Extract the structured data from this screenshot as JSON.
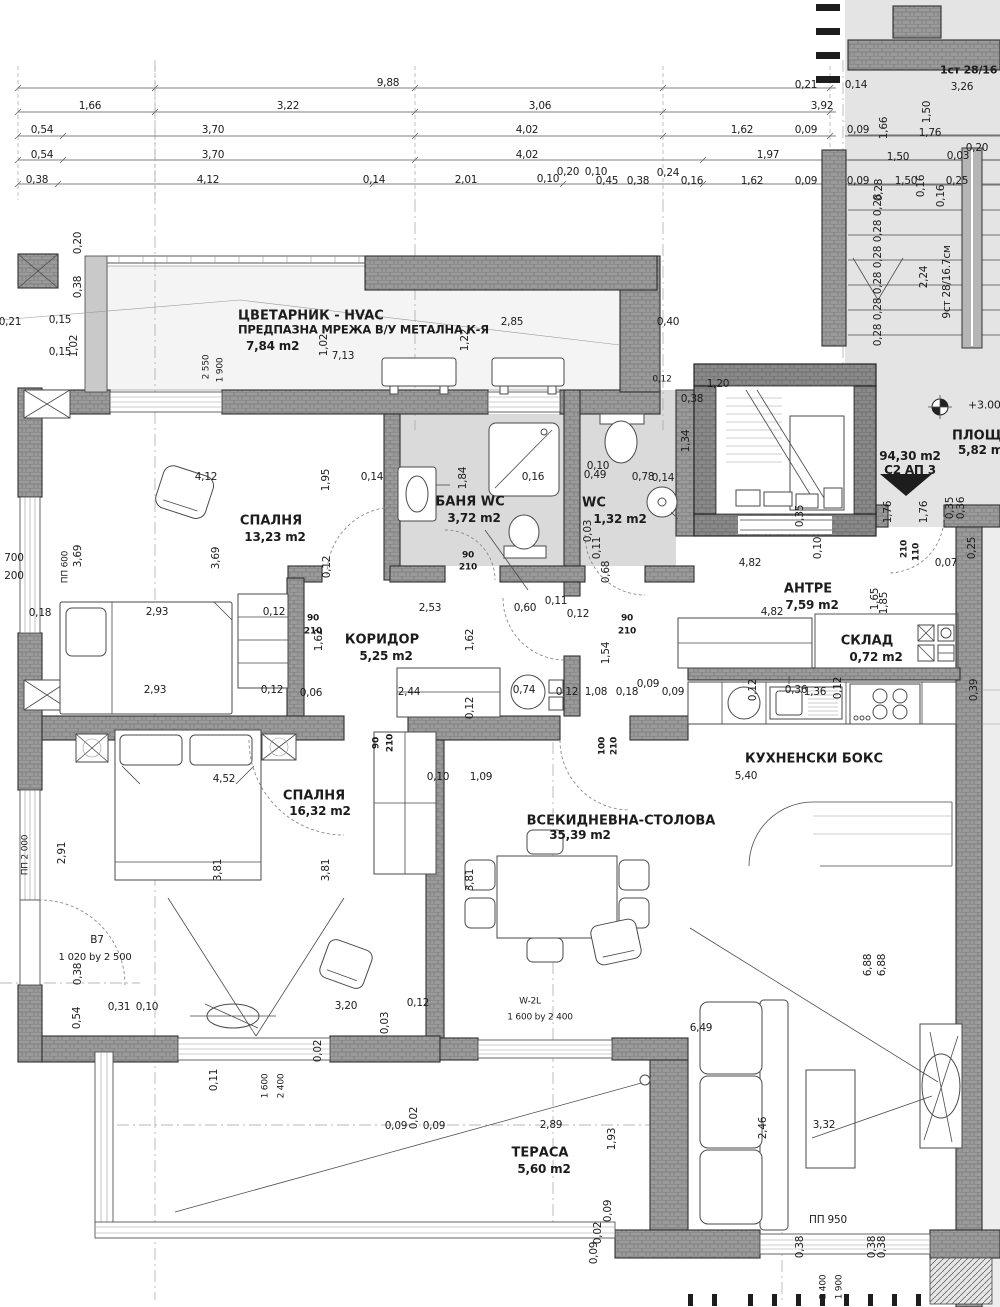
{
  "colors": {
    "paper": "#ffffff",
    "ink": "#1c1c1c",
    "wall_fill": "#9b9b9b",
    "wall_line": "#2f2f2f",
    "floor_tile": "#dadada",
    "stair_bg": "#e4e4e4"
  },
  "apartment": {
    "area_label": "94,30 m2",
    "unit_label": "С2 АП 3",
    "level_mark": "+3.00"
  },
  "stairs": {
    "flight_down": "1ст 28/16",
    "flight_up": "9ст 28/16.7см",
    "landing": "ПЛОЩАДКА 5,82 m2"
  },
  "rooms": [
    {
      "n": "СПАЛНЯ",
      "a": "13,23 m2",
      "x": 271,
      "y": 521
    },
    {
      "n": "БАНЯ WC",
      "a": "3,72 m2",
      "x": 470,
      "y": 502
    },
    {
      "n": "WC",
      "a": "1,32 m2",
      "x": 594,
      "y": 503,
      "ax": 620,
      "ay": 519
    },
    {
      "n": "КОРИДОР",
      "a": "5,25 m2",
      "x": 382,
      "y": 640
    },
    {
      "n": "АНТРЕ",
      "a": "7,59 m2",
      "x": 808,
      "y": 589
    },
    {
      "n": "СКЛАД",
      "a": "0,72 m2",
      "x": 867,
      "y": 641,
      "ax": 876,
      "ay": 657
    },
    {
      "n": "КУХНЕНСКИ БОКС",
      "a": "",
      "x": 814,
      "y": 759
    },
    {
      "n": "ВСЕКИДНЕВНА-СТОЛОВА",
      "a": "35,39 m2",
      "x": 621,
      "y": 821,
      "ax": 580,
      "ay": 835
    },
    {
      "n": "СПАЛНЯ",
      "a": "16,32 m2",
      "x": 314,
      "y": 796,
      "ax": 320,
      "ay": 811
    },
    {
      "n": "ТЕРАСА",
      "a": "5,60 m2",
      "x": 540,
      "y": 1153
    },
    {
      "n": "ЦВЕТАРНИК - HVAC",
      "note": "ПРЕДПАЗНА МРЕЖА В/У МЕТАЛНА К-Я",
      "a": "7,84 m2",
      "x": 238,
      "y": 316,
      "align": "l"
    },
    {
      "n": "ПЛОЩАДКА",
      "a": "5,82 m2",
      "x": 952,
      "y": 436,
      "ax": 958,
      "ay": 450,
      "align": "l"
    }
  ],
  "labels": [
    [
      "9,88",
      388,
      83
    ],
    [
      "0,21",
      806,
      85
    ],
    [
      "0,14",
      856,
      85
    ],
    [
      "1,66",
      90,
      106
    ],
    [
      "3,22",
      288,
      106
    ],
    [
      "3,06",
      540,
      106
    ],
    [
      "3,92",
      822,
      106
    ],
    [
      "0,54",
      42,
      130
    ],
    [
      "3,70",
      213,
      130
    ],
    [
      "4,02",
      527,
      130
    ],
    [
      "1,62",
      742,
      130
    ],
    [
      "0,09",
      806,
      130
    ],
    [
      "0,09",
      858,
      130
    ],
    [
      "1,76",
      930,
      133
    ],
    [
      "0,54",
      42,
      155
    ],
    [
      "3,70",
      213,
      155
    ],
    [
      "4,02",
      527,
      155
    ],
    [
      "1,97",
      768,
      155
    ],
    [
      "1,50",
      898,
      157
    ],
    [
      "0,03",
      958,
      156
    ],
    [
      "0,20",
      977,
      148
    ],
    [
      "0,38",
      37,
      180
    ],
    [
      "4,12",
      208,
      180
    ],
    [
      "0,14",
      374,
      180
    ],
    [
      "2,01",
      466,
      180
    ],
    [
      "0,10",
      548,
      179
    ],
    [
      "0,20",
      568,
      172
    ],
    [
      "0,10",
      596,
      172
    ],
    [
      "0,45",
      607,
      181
    ],
    [
      "0,38",
      638,
      181
    ],
    [
      "0,24",
      668,
      173
    ],
    [
      "0,16",
      692,
      181
    ],
    [
      "1,62",
      752,
      181
    ],
    [
      "0,09",
      806,
      181
    ],
    [
      "0,09",
      858,
      181
    ],
    [
      "1,50",
      906,
      181
    ],
    [
      "0,25",
      957,
      181
    ],
    [
      "1,66",
      884,
      128,
      -90
    ],
    [
      "1,50",
      927,
      112,
      -90
    ],
    [
      "0,28",
      879,
      190,
      -90
    ],
    [
      "0,16",
      921,
      186,
      -90
    ],
    [
      "1ст 28/16",
      940,
      70,
      0,
      11,
      1,
      "l"
    ],
    [
      "3,26",
      962,
      87
    ],
    [
      "9ст 28/16.7см",
      947,
      282,
      -90
    ],
    [
      "2,24",
      924,
      277,
      -90
    ],
    [
      "0,28",
      878,
      205,
      -90
    ],
    [
      "0,28",
      878,
      231,
      -90
    ],
    [
      "0,28",
      878,
      257,
      -90
    ],
    [
      "0,28",
      878,
      283,
      -90
    ],
    [
      "0,28",
      878,
      309,
      -90
    ],
    [
      "0,28",
      878,
      335,
      -90
    ],
    [
      "0,16",
      941,
      196,
      -90
    ],
    [
      "+3.00",
      968,
      405,
      0,
      11,
      0,
      "l"
    ],
    [
      "94,30 m2",
      910,
      456,
      0,
      12,
      1
    ],
    [
      "С2 АП 3",
      910,
      470,
      0,
      12,
      1
    ],
    [
      "1,76",
      888,
      512,
      -90
    ],
    [
      "1,76",
      924,
      512,
      -90
    ],
    [
      "0,35",
      950,
      508,
      -90
    ],
    [
      "0,36",
      961,
      508,
      -90
    ],
    [
      "7,13",
      343,
      356
    ],
    [
      "2,85",
      512,
      322
    ],
    [
      "1,02",
      324,
      345,
      -90
    ],
    [
      "1,22",
      465,
      340,
      -90
    ],
    [
      "2 550",
      207,
      367,
      -90,
      9
    ],
    [
      "1 900",
      221,
      370,
      -90,
      9
    ],
    [
      "0,40",
      668,
      322
    ],
    [
      "0,12",
      662,
      380,
      0,
      9
    ],
    [
      "0,20",
      78,
      243,
      -90
    ],
    [
      "0,38",
      78,
      287,
      -90
    ],
    [
      "0,21",
      10,
      322
    ],
    [
      "0,15",
      60,
      320
    ],
    [
      "0,15",
      60,
      352
    ],
    [
      "1,02",
      74,
      346,
      -90
    ],
    [
      "700",
      14,
      558
    ],
    [
      "200",
      14,
      576
    ],
    [
      "ПП 600",
      66,
      567,
      -90,
      9
    ],
    [
      "3,69",
      78,
      556,
      -90
    ],
    [
      "0,18",
      40,
      613
    ],
    [
      "4,12",
      206,
      477
    ],
    [
      "1,95",
      326,
      480,
      -90
    ],
    [
      "0,14",
      372,
      477
    ],
    [
      "3,69",
      216,
      558,
      -90
    ],
    [
      "0,12",
      327,
      567,
      -90
    ],
    [
      "2,93",
      157,
      612
    ],
    [
      "0,12",
      274,
      612
    ],
    [
      "2,93",
      155,
      690
    ],
    [
      "0,12",
      272,
      690
    ],
    [
      "0,06",
      311,
      693
    ],
    [
      "0,16",
      533,
      477
    ],
    [
      "1,84",
      463,
      478,
      -90
    ],
    [
      "0,49",
      595,
      475
    ],
    [
      "0,78",
      643,
      477
    ],
    [
      "0,14",
      663,
      478
    ],
    [
      "0,10",
      598,
      466
    ],
    [
      "1,34",
      686,
      441,
      -90
    ],
    [
      "0,11",
      597,
      548,
      -90
    ],
    [
      "0,68",
      606,
      572,
      -90
    ],
    [
      "0,03",
      588,
      531,
      -90
    ],
    [
      "90",
      468,
      556,
      0,
      9,
      1
    ],
    [
      "210",
      468,
      568,
      0,
      9,
      1
    ],
    [
      "90",
      313,
      619,
      0,
      9,
      1
    ],
    [
      "210",
      313,
      632,
      0,
      9,
      1
    ],
    [
      "90",
      627,
      619,
      0,
      9,
      1
    ],
    [
      "210",
      627,
      632,
      0,
      9,
      1
    ],
    [
      "210",
      905,
      549,
      -90,
      9,
      1
    ],
    [
      "110",
      917,
      552,
      -90,
      9,
      1
    ],
    [
      "100",
      603,
      746,
      -90,
      9,
      1
    ],
    [
      "210",
      615,
      746,
      -90,
      9,
      1
    ],
    [
      "90",
      377,
      743,
      -90,
      9,
      1
    ],
    [
      "210",
      391,
      743,
      -90,
      9,
      1
    ],
    [
      "2,53",
      430,
      608
    ],
    [
      "0,60",
      525,
      608
    ],
    [
      "0,11",
      556,
      601
    ],
    [
      "0,12",
      578,
      614
    ],
    [
      "1,62",
      319,
      640,
      -90
    ],
    [
      "1,62",
      470,
      640,
      -90
    ],
    [
      "2,44",
      409,
      692
    ],
    [
      "0,12",
      470,
      708,
      -90
    ],
    [
      "0,74",
      524,
      690
    ],
    [
      "1,20",
      718,
      384
    ],
    [
      "0,38",
      692,
      399
    ],
    [
      "0,35",
      800,
      516,
      -90
    ],
    [
      "0,10",
      818,
      548,
      -90
    ],
    [
      "4,82",
      750,
      563
    ],
    [
      "4,82",
      772,
      612
    ],
    [
      "1,65",
      875,
      599,
      -90
    ],
    [
      "1,85",
      884,
      603,
      -90
    ],
    [
      "0,07",
      946,
      563
    ],
    [
      "0,25",
      972,
      548,
      -90
    ],
    [
      "1,54",
      606,
      653,
      -90
    ],
    [
      "0,09",
      648,
      684
    ],
    [
      "0,09",
      673,
      692
    ],
    [
      "0,18",
      627,
      692
    ],
    [
      "1,08",
      596,
      692
    ],
    [
      "0,12",
      567,
      692
    ],
    [
      "0,36",
      796,
      690
    ],
    [
      "0,12",
      753,
      690,
      -90
    ],
    [
      "0,12",
      838,
      688,
      -90
    ],
    [
      "1,36",
      815,
      692
    ],
    [
      "0,39",
      974,
      690,
      -90
    ],
    [
      "5,40",
      746,
      776
    ],
    [
      "0,10",
      438,
      777
    ],
    [
      "1,09",
      481,
      777
    ],
    [
      "3,81",
      470,
      880,
      -90
    ],
    [
      "6,88",
      868,
      965,
      -90
    ],
    [
      "6,88",
      882,
      965,
      -90
    ],
    [
      "6,49",
      701,
      1028
    ],
    [
      "W-2L",
      530,
      1002,
      0,
      9
    ],
    [
      "1 600 by 2 400",
      540,
      1018,
      0,
      9
    ],
    [
      "2,46",
      763,
      1128,
      -90
    ],
    [
      "3,32",
      824,
      1125
    ],
    [
      "0,12",
      418,
      1003
    ],
    [
      "4,52",
      224,
      779
    ],
    [
      "3,81",
      218,
      870,
      -90
    ],
    [
      "3,81",
      326,
      870,
      -90
    ],
    [
      "2,91",
      62,
      853,
      -90
    ],
    [
      "ПП 2 000",
      26,
      855,
      -90,
      9
    ],
    [
      "В7",
      97,
      940
    ],
    [
      "1 020 by 2 500",
      95,
      958,
      0,
      10
    ],
    [
      "0,38",
      78,
      974,
      -90
    ],
    [
      "0,54",
      77,
      1018,
      -90
    ],
    [
      "0,31",
      119,
      1007
    ],
    [
      "0,10",
      147,
      1007
    ],
    [
      "3,20",
      346,
      1006
    ],
    [
      "0,03",
      385,
      1023,
      -90
    ],
    [
      "0,11",
      214,
      1080,
      -90
    ],
    [
      "1 600",
      266,
      1086,
      -90,
      9
    ],
    [
      "2 400",
      282,
      1086,
      -90,
      9
    ],
    [
      "0,02",
      318,
      1051,
      -90
    ],
    [
      "2,89",
      551,
      1125
    ],
    [
      "0,09",
      396,
      1126
    ],
    [
      "0,02",
      414,
      1118,
      -90
    ],
    [
      "0,09",
      434,
      1126
    ],
    [
      "1,93",
      612,
      1139,
      -90
    ],
    [
      "0,09",
      608,
      1211,
      -90
    ],
    [
      "0,02",
      598,
      1233,
      -90
    ],
    [
      "0,09",
      594,
      1253,
      -90
    ],
    [
      "ПП 950",
      828,
      1220
    ],
    [
      "0,38",
      800,
      1247,
      -90
    ],
    [
      "0,38",
      872,
      1247,
      -90
    ],
    [
      "0,38",
      882,
      1247,
      -90
    ],
    [
      "2 400",
      824,
      1287,
      -90,
      9
    ],
    [
      "1 900",
      840,
      1287,
      -90,
      9
    ]
  ]
}
